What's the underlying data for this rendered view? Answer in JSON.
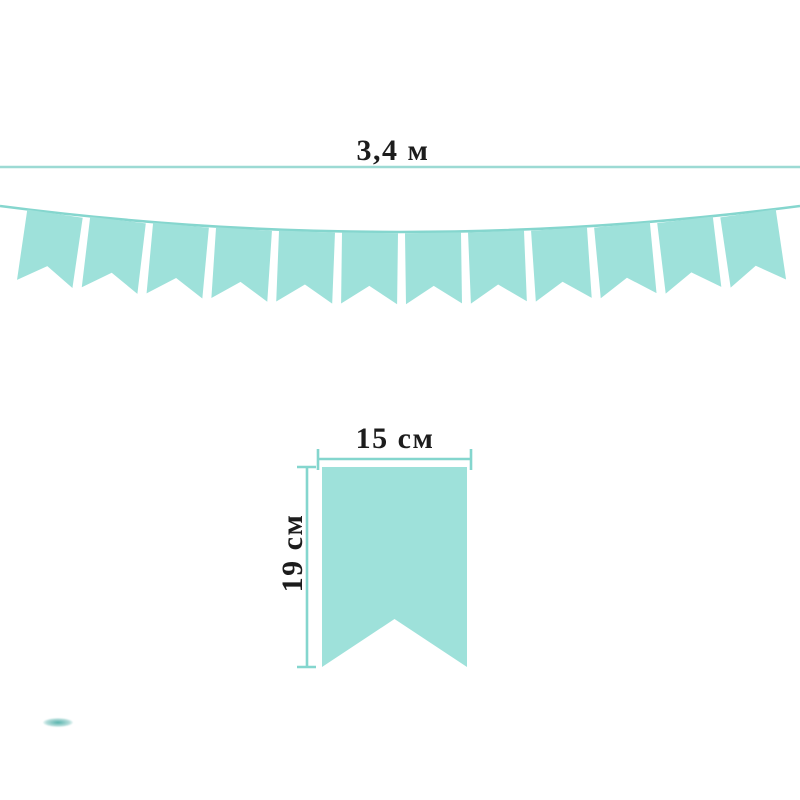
{
  "diagram": {
    "background_color": "#ffffff",
    "text_color": "#1c1c1c"
  },
  "garland": {
    "length_label": "3,4 м",
    "flag_count": 12,
    "flag_color": "#9EE1DA",
    "string_color": "#85D6CE",
    "length_line_color": "#9CDAD4"
  },
  "single_flag": {
    "width_label": "15 см",
    "height_label": "19 см",
    "flag_color": "#9EE1DA",
    "dimension_line_color": "#84D6CE"
  },
  "watermark": {
    "color": "#2DA098"
  }
}
